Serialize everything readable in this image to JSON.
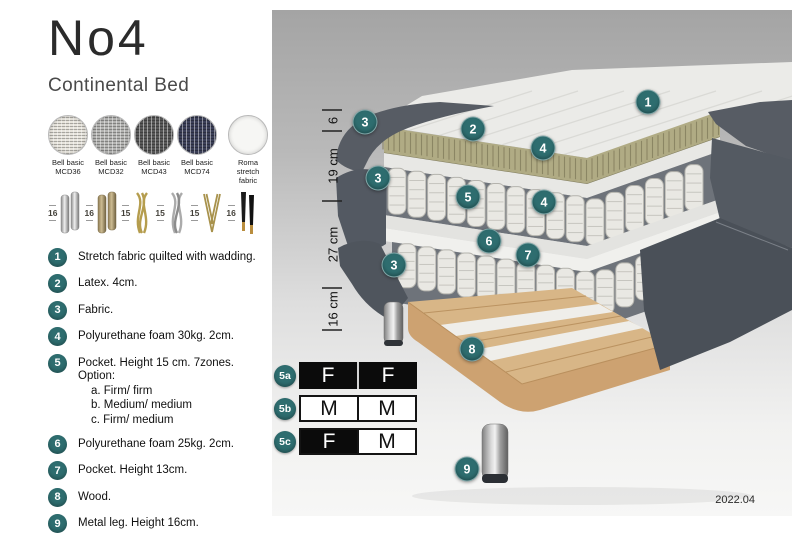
{
  "product": {
    "title": "No4",
    "subtitle": "Continental Bed"
  },
  "fabrics": [
    {
      "line1": "Bell basic",
      "line2": "MCD36",
      "color": "#e7e4dc",
      "texture": "weave"
    },
    {
      "line1": "Bell basic",
      "line2": "MCD32",
      "color": "#b4b4b2",
      "texture": "weave"
    },
    {
      "line1": "Bell basic",
      "line2": "MCD43",
      "color": "#595959",
      "texture": "weave"
    },
    {
      "line1": "Bell basic",
      "line2": "MCD74",
      "color": "#3c4059",
      "texture": "weave"
    },
    {
      "line1": "Roma",
      "line2": "stretch fabric",
      "color": "#f6f6f4",
      "texture": "plain"
    }
  ],
  "legs": [
    {
      "height": "16",
      "style": "cylinder-chrome"
    },
    {
      "height": "16",
      "style": "cylinder-bronze"
    },
    {
      "height": "15",
      "style": "twist-gold"
    },
    {
      "height": "15",
      "style": "twist-silver"
    },
    {
      "height": "15",
      "style": "hairpin-gold"
    },
    {
      "height": "16",
      "style": "taper-black-gold"
    }
  ],
  "features": [
    {
      "num": "1",
      "text": "Stretch fabric quilted with wadding."
    },
    {
      "num": "2",
      "text": "Latex. 4cm."
    },
    {
      "num": "3",
      "text": "Fabric."
    },
    {
      "num": "4",
      "text": "Polyurethane foam 30kg. 2cm."
    },
    {
      "num": "5",
      "text": "Pocket. Height 15 cm. 7zones. Option:",
      "options": [
        "a. Firm/ firm",
        "b. Medium/ medium",
        "c. Firm/ medium"
      ]
    },
    {
      "num": "6",
      "text": "Polyurethane foam 25kg. 2cm."
    },
    {
      "num": "7",
      "text": "Pocket. Height 13cm."
    },
    {
      "num": "8",
      "text": "Wood."
    },
    {
      "num": "9",
      "text": "Metal leg. Height 16cm."
    }
  ],
  "dimensions": [
    "6",
    "19 cm",
    "27 cm",
    "16 cm"
  ],
  "callouts": [
    "1",
    "2",
    "3",
    "3",
    "4",
    "5",
    "4",
    "3",
    "6",
    "7",
    "8",
    "9"
  ],
  "firmness_options": [
    {
      "label": "5a",
      "cells": [
        {
          "text": "F",
          "fill": "black"
        },
        {
          "text": "F",
          "fill": "black"
        }
      ]
    },
    {
      "label": "5b",
      "cells": [
        {
          "text": "M",
          "fill": "white"
        },
        {
          "text": "M",
          "fill": "white"
        }
      ]
    },
    {
      "label": "5c",
      "cells": [
        {
          "text": "F",
          "fill": "black"
        },
        {
          "text": "M",
          "fill": "white"
        }
      ]
    }
  ],
  "version": "2022.04",
  "colors": {
    "accent_teal": "#2e6d6f",
    "bed_fabric_gray": "#545a62",
    "latex_olive": "#b0ab84",
    "wood_tan": "#d8b687"
  }
}
